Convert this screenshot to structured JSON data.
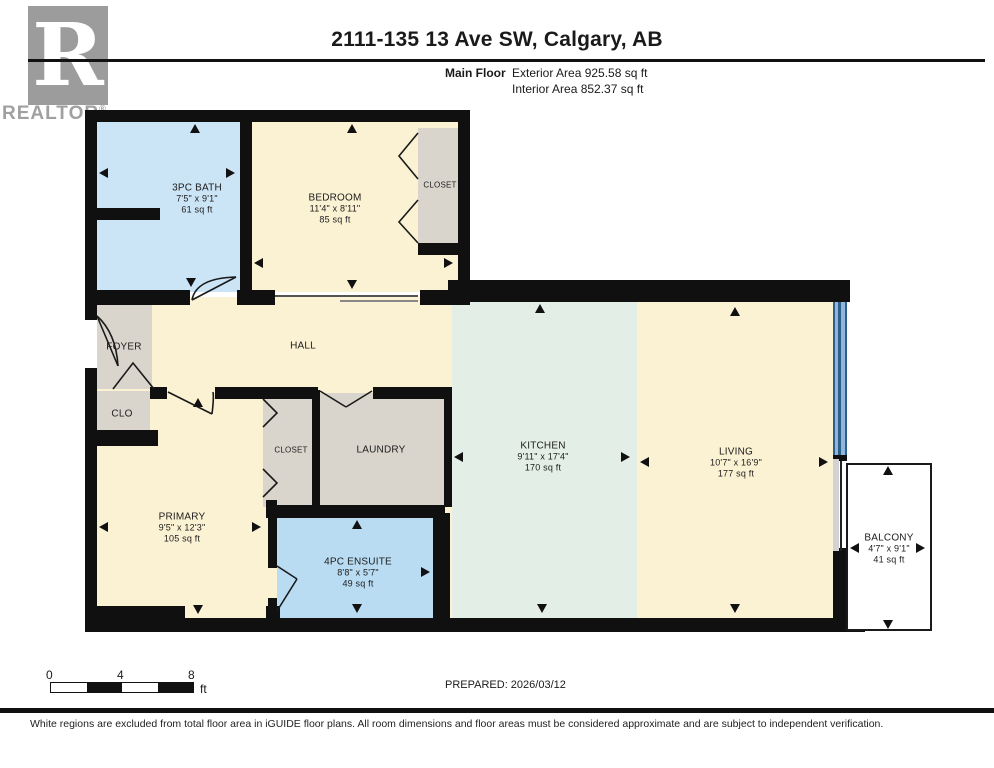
{
  "header": {
    "title": "2111-135 13 Ave SW, Calgary, AB",
    "floor_label": "Main Floor",
    "exterior_area": "Exterior Area 925.58 sq ft",
    "interior_area": "Interior Area 852.37 sq ft"
  },
  "logo": {
    "letter": "R",
    "brand": "REALTOR",
    "registered": "®"
  },
  "rooms": {
    "bath": {
      "name": "3PC BATH",
      "dims": "7'5\" x 9'1\"",
      "area": "61 sq ft"
    },
    "bedroom": {
      "name": "BEDROOM",
      "dims": "11'4\" x 8'11\"",
      "area": "85 sq ft"
    },
    "bedroom_closet": {
      "name": "CLOSET"
    },
    "foyer": {
      "name": "FOYER"
    },
    "hall": {
      "name": "HALL"
    },
    "clo": {
      "name": "CLO"
    },
    "closet": {
      "name": "CLOSET"
    },
    "laundry": {
      "name": "LAUNDRY"
    },
    "primary": {
      "name": "PRIMARY",
      "dims": "9'5\" x 12'3\"",
      "area": "105 sq ft"
    },
    "ensuite": {
      "name": "4PC ENSUITE",
      "dims": "8'8\" x 5'7\"",
      "area": "49 sq ft"
    },
    "kitchen": {
      "name": "KITCHEN",
      "dims": "9'11\" x 17'4\"",
      "area": "170 sq ft"
    },
    "living": {
      "name": "LIVING",
      "dims": "10'7\" x 16'9\"",
      "area": "177 sq ft"
    },
    "balcony": {
      "name": "BALCONY",
      "dims": "4'7\" x 9'1\"",
      "area": "41 sq ft"
    }
  },
  "scale_bar": {
    "tick_0": "0",
    "tick_4": "4",
    "tick_8": "8",
    "unit": "ft"
  },
  "footer": {
    "prepared": "PREPARED: 2026/03/12",
    "disclaimer": "White regions are excluded from total floor area in iGUIDE floor plans. All room dimensions and floor areas must be considered approximate and are subject to independent verification."
  },
  "colors": {
    "wall": "#101010",
    "floor_cream": "#FBF1D3",
    "bath_blue": "#CBE4F6",
    "ensuite_blue": "#B9DCF3",
    "kitchen_green": "#E3EEE7",
    "closet_gray": "#D9D5CD",
    "window_blue": "#2D5E8C",
    "logo_gray": "#9C9C9C"
  }
}
